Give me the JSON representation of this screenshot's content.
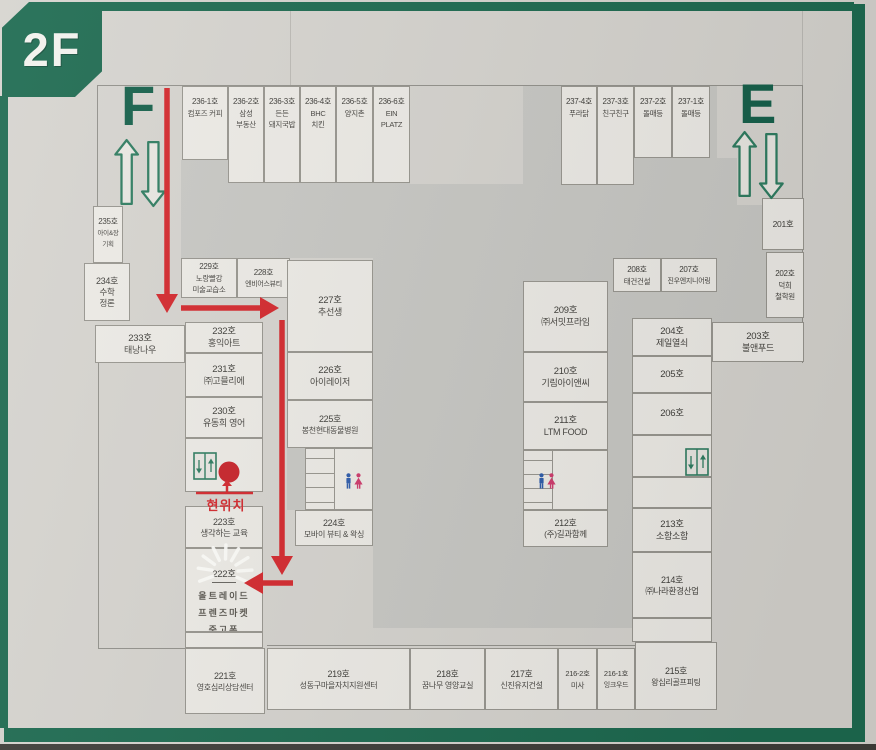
{
  "floor_label": "2F",
  "current_location": {
    "label": "현위치",
    "line": {
      "x1": 196,
      "y1": 493,
      "x2": 253,
      "y2": 493
    },
    "arrow": {
      "x": 227,
      "y_from": 493,
      "y_to": 486,
      "tip_y": 480
    }
  },
  "colors": {
    "frame_green": "#1d6a50",
    "stair_green": "#15604a",
    "route_red": "#d4282d",
    "dot_red": "#c8232a",
    "room_fill": "#edebe6",
    "void_fill": "#c8c8c4",
    "man_blue": "#2d5cab",
    "woman_pink": "#cf3a6c"
  },
  "stairwells": [
    {
      "label": "F",
      "letter_x": 121,
      "letter_y": 78,
      "arrows_x": 112,
      "arrows_y": 136
    },
    {
      "label": "E",
      "letter_x": 739,
      "letter_y": 76,
      "arrows_x": 730,
      "arrows_y": 128
    }
  ],
  "rooms": [
    {
      "num": "236-1호",
      "name": [
        "컴포즈 커피"
      ],
      "x": 182,
      "y": 86,
      "w": 46,
      "h": 74,
      "align": "top",
      "fs": [
        8,
        7.5
      ]
    },
    {
      "num": "236-2호",
      "name": [
        "삼성",
        "부동산"
      ],
      "x": 228,
      "y": 86,
      "w": 36,
      "h": 97,
      "align": "top",
      "fs": [
        8,
        7.5
      ]
    },
    {
      "num": "236-3호",
      "name": [
        "든든",
        "돼지국밥"
      ],
      "x": 264,
      "y": 86,
      "w": 36,
      "h": 97,
      "align": "top",
      "fs": [
        8,
        7.5
      ]
    },
    {
      "num": "236-4호",
      "name": [
        "BHC",
        "치킨"
      ],
      "x": 300,
      "y": 86,
      "w": 36,
      "h": 97,
      "align": "top",
      "fs": [
        8,
        7.5
      ]
    },
    {
      "num": "236-5호",
      "name": [
        "양지촌"
      ],
      "x": 336,
      "y": 86,
      "w": 37,
      "h": 97,
      "align": "top",
      "fs": [
        8,
        7.5
      ]
    },
    {
      "num": "236-6호",
      "name": [
        "EIN",
        "PLATZ"
      ],
      "x": 373,
      "y": 86,
      "w": 37,
      "h": 97,
      "align": "top",
      "fs": [
        8,
        7.5
      ]
    },
    {
      "num": "237-4호",
      "name": [
        "푸라닭"
      ],
      "x": 561,
      "y": 86,
      "w": 36,
      "h": 99,
      "align": "top",
      "fs": [
        8,
        7.5
      ]
    },
    {
      "num": "237-3호",
      "name": [
        "친구친구"
      ],
      "x": 597,
      "y": 86,
      "w": 37,
      "h": 99,
      "align": "top",
      "fs": [
        8,
        7.5
      ]
    },
    {
      "num": "237-2호",
      "name": [
        "돌매등"
      ],
      "x": 634,
      "y": 86,
      "w": 38,
      "h": 72,
      "align": "top",
      "fs": [
        8,
        7.5
      ]
    },
    {
      "num": "237-1호",
      "name": [
        "돌매등"
      ],
      "x": 672,
      "y": 86,
      "w": 38,
      "h": 72,
      "align": "top",
      "fs": [
        8,
        7.5
      ]
    },
    {
      "num": "235호",
      "name": [
        "아이&장",
        "기획"
      ],
      "x": 93,
      "y": 206,
      "w": 30,
      "h": 57,
      "align": "top",
      "fs": [
        8,
        6.5
      ]
    },
    {
      "num": "234호",
      "name": [
        "수학",
        "정론"
      ],
      "x": 84,
      "y": 263,
      "w": 46,
      "h": 58,
      "fs": [
        9,
        8.5
      ]
    },
    {
      "num": "233호",
      "name": [
        "태낭나우"
      ],
      "x": 95,
      "y": 325,
      "w": 90,
      "h": 38
    },
    {
      "num": "232호",
      "name": [
        "홍익아트"
      ],
      "x": 185,
      "y": 322,
      "w": 78,
      "h": 31
    },
    {
      "num": "231호",
      "name": [
        "㈜고믈리에"
      ],
      "x": 185,
      "y": 353,
      "w": 78,
      "h": 44
    },
    {
      "num": "230호",
      "name": [
        "유동희 영어"
      ],
      "x": 185,
      "y": 397,
      "w": 78,
      "h": 41
    },
    {
      "num": "",
      "name": [],
      "x": 185,
      "y": 438,
      "w": 78,
      "h": 54,
      "icon": "elevator",
      "icon_x": 7,
      "icon_y": 13
    },
    {
      "num": "223호",
      "name": [
        "생각하는 교육"
      ],
      "x": 185,
      "y": 506,
      "w": 78,
      "h": 42,
      "fs": [
        9,
        8.5
      ]
    },
    {
      "num": "222호",
      "name": [
        "올트레이드",
        "프렌즈마켓",
        "중고폰"
      ],
      "x": 185,
      "y": 548,
      "w": 78,
      "h": 84,
      "align": "top",
      "style": "highlight",
      "fs": [
        9.5,
        8.5
      ]
    },
    {
      "num": "",
      "name": [],
      "x": 185,
      "y": 632,
      "w": 78,
      "h": 16
    },
    {
      "num": "221호",
      "name": [
        "영호심리상담센터"
      ],
      "x": 185,
      "y": 648,
      "w": 80,
      "h": 66,
      "fs": [
        9,
        8
      ]
    },
    {
      "num": "229호",
      "name": [
        "노랑빨강",
        "미술교습소"
      ],
      "x": 181,
      "y": 258,
      "w": 56,
      "h": 40,
      "fs": [
        8,
        7.5
      ]
    },
    {
      "num": "228호",
      "name": [
        "엔비어스뷰티"
      ],
      "x": 237,
      "y": 258,
      "w": 53,
      "h": 40,
      "fs": [
        8,
        7
      ]
    },
    {
      "num": "227호",
      "name": [
        "추선생"
      ],
      "x": 287,
      "y": 260,
      "w": 86,
      "h": 92
    },
    {
      "num": "226호",
      "name": [
        "아이레이저"
      ],
      "x": 287,
      "y": 352,
      "w": 86,
      "h": 48
    },
    {
      "num": "225호",
      "name": [
        "봉천현대동물병원"
      ],
      "x": 287,
      "y": 400,
      "w": 86,
      "h": 48,
      "fs": [
        9,
        8
      ]
    },
    {
      "num": "224호",
      "name": [
        "모바이 뷰티 & 왁싱"
      ],
      "x": 295,
      "y": 510,
      "w": 78,
      "h": 36,
      "fs": [
        9,
        8
      ]
    },
    {
      "num": "209호",
      "name": [
        "㈜서밋프라임"
      ],
      "x": 523,
      "y": 281,
      "w": 85,
      "h": 71
    },
    {
      "num": "210호",
      "name": [
        "기림아이앤씨"
      ],
      "x": 523,
      "y": 352,
      "w": 85,
      "h": 50
    },
    {
      "num": "211호",
      "name": [
        "LTM FOOD"
      ],
      "x": 523,
      "y": 402,
      "w": 85,
      "h": 48
    },
    {
      "num": "212호",
      "name": [
        "(주)길과함께"
      ],
      "x": 523,
      "y": 510,
      "w": 85,
      "h": 37,
      "fs": [
        9,
        8.5
      ]
    },
    {
      "num": "208호",
      "name": [
        "태건건설"
      ],
      "x": 613,
      "y": 258,
      "w": 48,
      "h": 34,
      "fs": [
        8,
        7.5
      ]
    },
    {
      "num": "207호",
      "name": [
        "진우엔지니어링"
      ],
      "x": 661,
      "y": 258,
      "w": 56,
      "h": 34,
      "fs": [
        8,
        7
      ]
    },
    {
      "num": "204호",
      "name": [
        "제일열쇠"
      ],
      "x": 632,
      "y": 318,
      "w": 80,
      "h": 38
    },
    {
      "num": "205호",
      "name": [],
      "x": 632,
      "y": 356,
      "w": 80,
      "h": 37
    },
    {
      "num": "206호",
      "name": [],
      "x": 632,
      "y": 393,
      "w": 80,
      "h": 42
    },
    {
      "num": "",
      "name": [],
      "x": 632,
      "y": 435,
      "w": 80,
      "h": 42,
      "icon": "elevator",
      "icon_x": 52,
      "icon_y": 12
    },
    {
      "num": "",
      "name": [],
      "x": 632,
      "y": 477,
      "w": 80,
      "h": 31
    },
    {
      "num": "213호",
      "name": [
        "소함소함"
      ],
      "x": 632,
      "y": 508,
      "w": 80,
      "h": 44
    },
    {
      "num": "214호",
      "name": [
        "㈜나라환경산업"
      ],
      "x": 632,
      "y": 552,
      "w": 80,
      "h": 66,
      "fs": [
        9,
        8.5
      ]
    },
    {
      "num": "",
      "name": [],
      "x": 632,
      "y": 618,
      "w": 80,
      "h": 24
    },
    {
      "num": "201호",
      "name": [],
      "x": 762,
      "y": 198,
      "w": 42,
      "h": 52,
      "fs": [
        8.5,
        8
      ]
    },
    {
      "num": "202호",
      "name": [
        "덕희",
        "철학원"
      ],
      "x": 766,
      "y": 252,
      "w": 38,
      "h": 66,
      "fs": [
        8,
        7.5
      ]
    },
    {
      "num": "203호",
      "name": [
        "불앤푸드"
      ],
      "x": 712,
      "y": 322,
      "w": 92,
      "h": 40
    },
    {
      "num": "219호",
      "name": [
        "성동구마을자치지원센터"
      ],
      "x": 267,
      "y": 648,
      "w": 143,
      "h": 62,
      "fs": [
        9,
        8
      ]
    },
    {
      "num": "218호",
      "name": [
        "꿈나무 영양교실"
      ],
      "x": 410,
      "y": 648,
      "w": 75,
      "h": 62,
      "fs": [
        9,
        8
      ]
    },
    {
      "num": "217호",
      "name": [
        "신진유지건설"
      ],
      "x": 485,
      "y": 648,
      "w": 73,
      "h": 62,
      "fs": [
        9,
        8
      ]
    },
    {
      "num": "216-2호",
      "name": [
        "미사"
      ],
      "x": 558,
      "y": 648,
      "w": 39,
      "h": 62,
      "fs": [
        7.5,
        7.5
      ]
    },
    {
      "num": "216-1호",
      "name": [
        "잉크우드"
      ],
      "x": 597,
      "y": 648,
      "w": 38,
      "h": 62,
      "fs": [
        7.5,
        7
      ]
    },
    {
      "num": "215호",
      "name": [
        "왕십리골프피팅"
      ],
      "x": 635,
      "y": 642,
      "w": 82,
      "h": 68,
      "fs": [
        9,
        8
      ]
    }
  ],
  "restrooms": [
    {
      "x": 305,
      "y": 448,
      "w": 68,
      "h": 62,
      "icon_x": 38,
      "icon_y": 24
    },
    {
      "x": 523,
      "y": 450,
      "w": 85,
      "h": 60,
      "icon_x": 13,
      "icon_y": 22
    }
  ],
  "voids": [
    {
      "x": 181,
      "y": 160,
      "w": 229,
      "h": 98
    },
    {
      "x": 373,
      "y": 184,
      "w": 150,
      "h": 444
    },
    {
      "x": 523,
      "y": 86,
      "w": 194,
      "h": 236
    },
    {
      "x": 712,
      "y": 158,
      "w": 25,
      "h": 164
    },
    {
      "x": 737,
      "y": 205,
      "w": 65,
      "h": 117
    },
    {
      "x": 608,
      "y": 322,
      "w": 24,
      "h": 306
    },
    {
      "x": 523,
      "y": 547,
      "w": 85,
      "h": 81
    },
    {
      "x": 287,
      "y": 448,
      "w": 18,
      "h": 62
    }
  ],
  "outlines": [
    {
      "x": 97,
      "y": 85,
      "w": 706,
      "h": 1
    },
    {
      "x": 97,
      "y": 85,
      "w": 1,
      "h": 122
    },
    {
      "x": 98,
      "y": 363,
      "w": 1,
      "h": 286
    },
    {
      "x": 98,
      "y": 648,
      "w": 88,
      "h": 1
    },
    {
      "x": 802,
      "y": 85,
      "w": 1,
      "h": 278
    },
    {
      "x": 267,
      "y": 645,
      "w": 450,
      "h": 1
    },
    {
      "x": 290,
      "y": 11,
      "w": 1,
      "h": 74,
      "light": true
    },
    {
      "x": 802,
      "y": 11,
      "w": 1,
      "h": 74,
      "light": true
    }
  ],
  "route": {
    "segments": [
      {
        "x1": 167,
        "y1": 88,
        "x2": 167,
        "y2": 294,
        "dir": "down"
      },
      {
        "x1": 181,
        "y1": 308,
        "x2": 260,
        "y2": 308,
        "dir": "right"
      },
      {
        "x1": 282,
        "y1": 320,
        "x2": 282,
        "y2": 556,
        "dir": "down"
      },
      {
        "x1": 293,
        "y1": 583,
        "x2": 263,
        "y2": 583,
        "dir": "left"
      }
    ],
    "dot": {
      "cx": 229,
      "cy": 472,
      "r": 10.5
    }
  },
  "highlight": {
    "room": "222호",
    "cx": 225,
    "cy": 572,
    "r1": 13,
    "r2": 27,
    "angles": [
      200,
      172,
      144,
      116,
      88,
      60,
      32,
      4,
      -24
    ]
  }
}
